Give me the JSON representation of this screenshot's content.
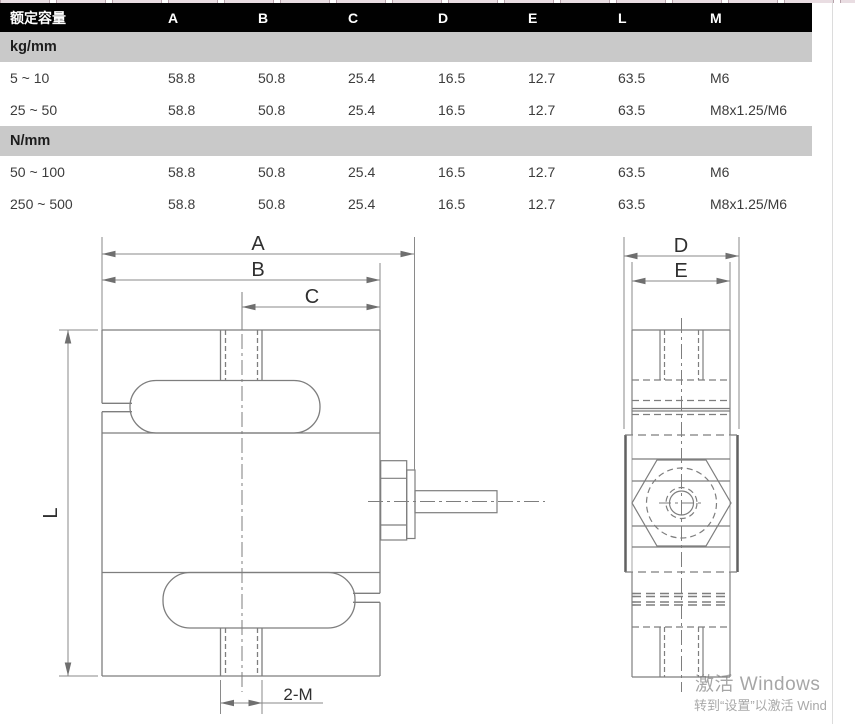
{
  "table": {
    "columns": [
      "额定容量",
      "A",
      "B",
      "C",
      "D",
      "E",
      "L",
      "M"
    ],
    "sections": [
      {
        "unit": "kg/mm",
        "rows": [
          {
            "cells": [
              "5 ~ 10",
              "58.8",
              "50.8",
              "25.4",
              "16.5",
              "12.7",
              "63.5",
              "M6"
            ]
          },
          {
            "cells": [
              "25 ~ 50",
              "58.8",
              "50.8",
              "25.4",
              "16.5",
              "12.7",
              "63.5",
              "M8x1.25/M6"
            ]
          }
        ]
      },
      {
        "unit": "N/mm",
        "rows": [
          {
            "cells": [
              "50 ~ 100",
              "58.8",
              "50.8",
              "25.4",
              "16.5",
              "12.7",
              "63.5",
              "M6"
            ]
          },
          {
            "cells": [
              "250 ~ 500",
              "58.8",
              "50.8",
              "25.4",
              "16.5",
              "12.7",
              "63.5",
              "M8x1.25/M6"
            ]
          }
        ]
      }
    ]
  },
  "drawing": {
    "labels": {
      "dim_a": "A",
      "dim_b": "B",
      "dim_c": "C",
      "dim_d": "D",
      "dim_e": "E",
      "dim_l": "L",
      "dim_m": "2-M"
    }
  },
  "watermark": {
    "line1": "激活 Windows",
    "line2": "转到“设置”以激活 Wind"
  },
  "colors": {
    "header_bg": "#010101",
    "unit_band_bg": "#c9c9c9",
    "drawing_line": "#7e7e7e"
  }
}
